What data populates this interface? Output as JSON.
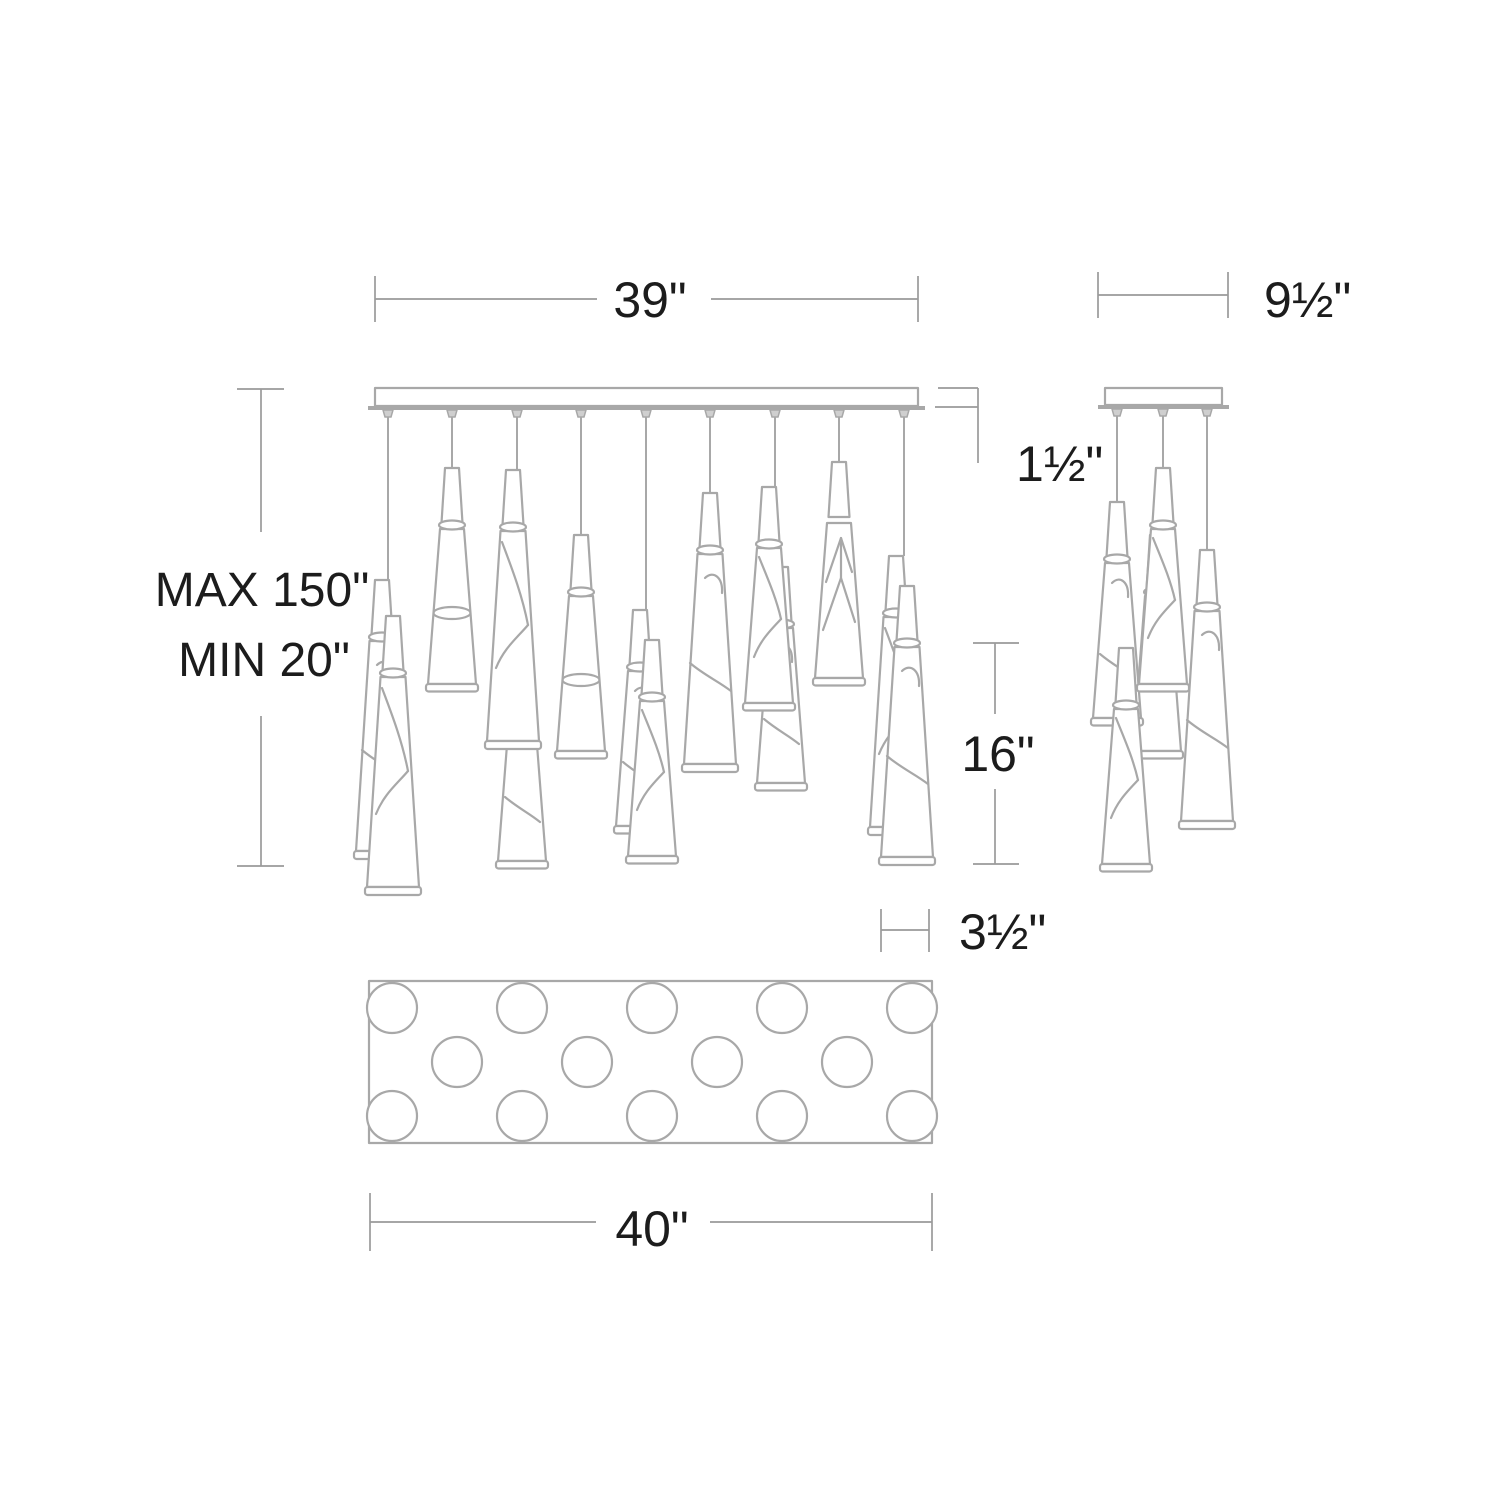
{
  "colors": {
    "background": "#ffffff",
    "line-color": "#a8a8a8",
    "dim-color": "#9a9a9a",
    "text-color": "#1c1c1c",
    "fitting-fill": "#cfcfcf"
  },
  "dimensions": {
    "canopy_length": "39\"",
    "side_canopy_width": "9½\"",
    "canopy_thickness": "1½\"",
    "suspension_max": "MAX 150\"",
    "suspension_min": "MIN 20\"",
    "shade_height": "16\"",
    "shade_diameter": "3½\"",
    "overall_length": "40\""
  },
  "views": {
    "front": {
      "pendant_cords": 9
    },
    "side": {
      "pendant_cords": 3
    },
    "bottom": {
      "light_circles": 14
    }
  }
}
